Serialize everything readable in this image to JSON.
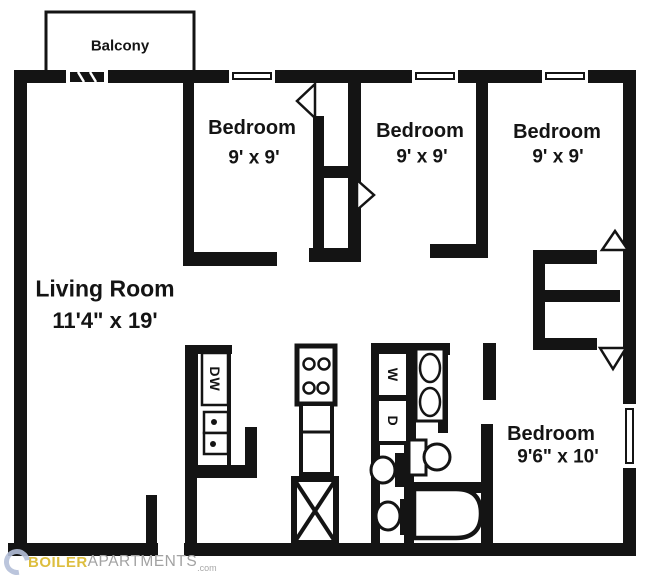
{
  "floorplan": {
    "balcony": {
      "label": "Balcony"
    },
    "living_room": {
      "label": "Living Room",
      "dims": "11'4\" x 19'"
    },
    "bedrooms": [
      {
        "label": "Bedroom",
        "dims": "9' x 9'"
      },
      {
        "label": "Bedroom",
        "dims": "9' x 9'"
      },
      {
        "label": "Bedroom",
        "dims": "9' x 9'"
      },
      {
        "label": "Bedroom",
        "dims": "9'6\" x 10'"
      }
    ],
    "appliances": {
      "dishwasher": "DW",
      "washer": "W",
      "dryer": "D"
    }
  },
  "watermark": {
    "name_part1": "BOILER",
    "name_part2": "APARTMENTS",
    "suffix": ".com"
  },
  "colors": {
    "line": "#141414",
    "background": "#ffffff",
    "watermark_gold": "#ddbe3e",
    "watermark_gray": "#a2a2a2",
    "watermark_logo_ring": "#b4bfd9"
  }
}
